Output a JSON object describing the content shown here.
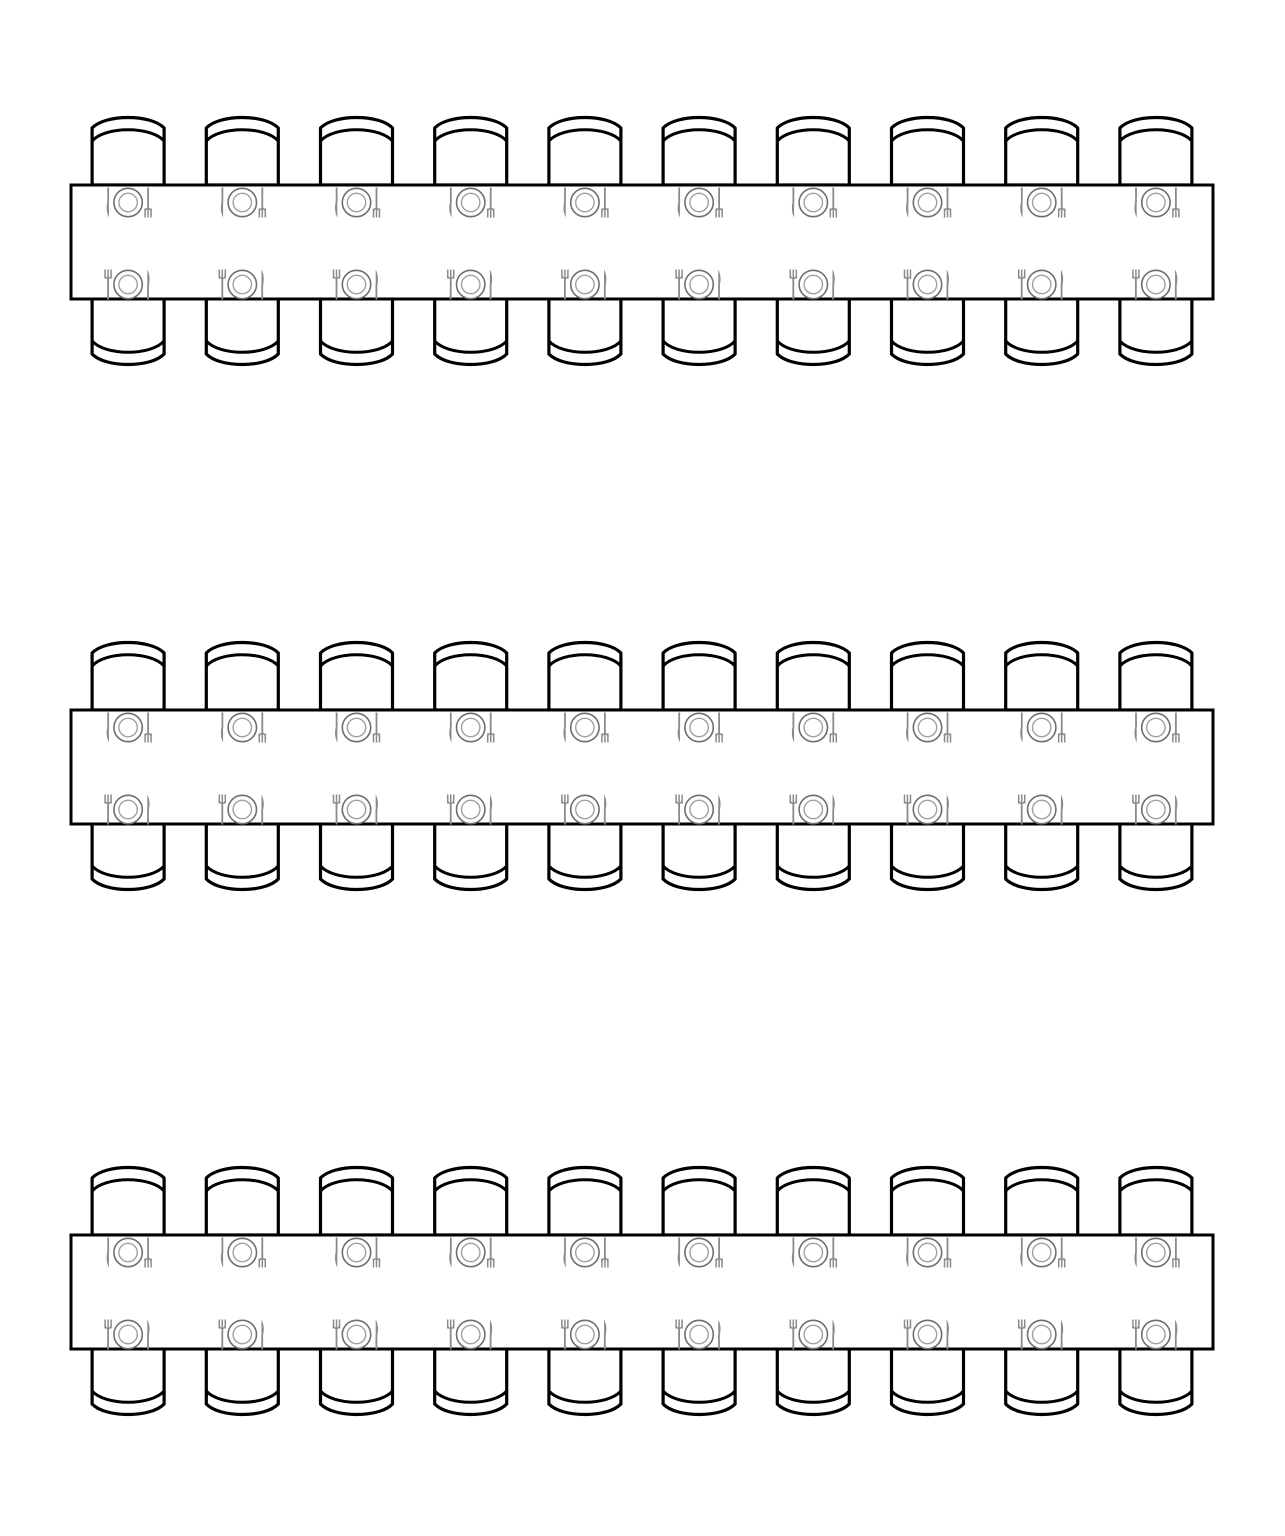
{
  "page": {
    "background": "#ffffff",
    "width": 1285,
    "height": 1536
  },
  "diagram": {
    "kind": "banquet-seating-plan",
    "description": "Three long rectangular banquet tables, each with ten place settings on each long side",
    "colors": {
      "outline": "#000000",
      "fill": "#ffffff",
      "cutlery": "#8a8a8a",
      "plate_outer": "#6e6e6e",
      "plate_inner": "#a0a0a0"
    },
    "icons": {
      "seat": "chair-icon",
      "cover": "place-setting-icon",
      "cover_parts": [
        "fork-icon",
        "plate-icon",
        "knife-icon"
      ]
    },
    "tables": [
      {
        "name": "table-1",
        "seats_top": 10,
        "seats_bottom": 10,
        "total_seats": 20
      },
      {
        "name": "table-2",
        "seats_top": 10,
        "seats_bottom": 10,
        "total_seats": 20
      },
      {
        "name": "table-3",
        "seats_top": 10,
        "seats_bottom": 10,
        "total_seats": 20
      }
    ],
    "layout": {
      "table_left": 71,
      "table_width": 1142,
      "table_height": 114,
      "table_tops": [
        185,
        710,
        1235
      ],
      "seat_spacing": 114.2,
      "chair_width": 76,
      "chair_height": 70,
      "table_stroke": 3,
      "chair_stroke": 3.2,
      "plate_outer_radius": 14.2,
      "plate_inner_radius": 9.2,
      "top_setting_offset": 17.5,
      "bottom_setting_offset": 14.5
    }
  }
}
